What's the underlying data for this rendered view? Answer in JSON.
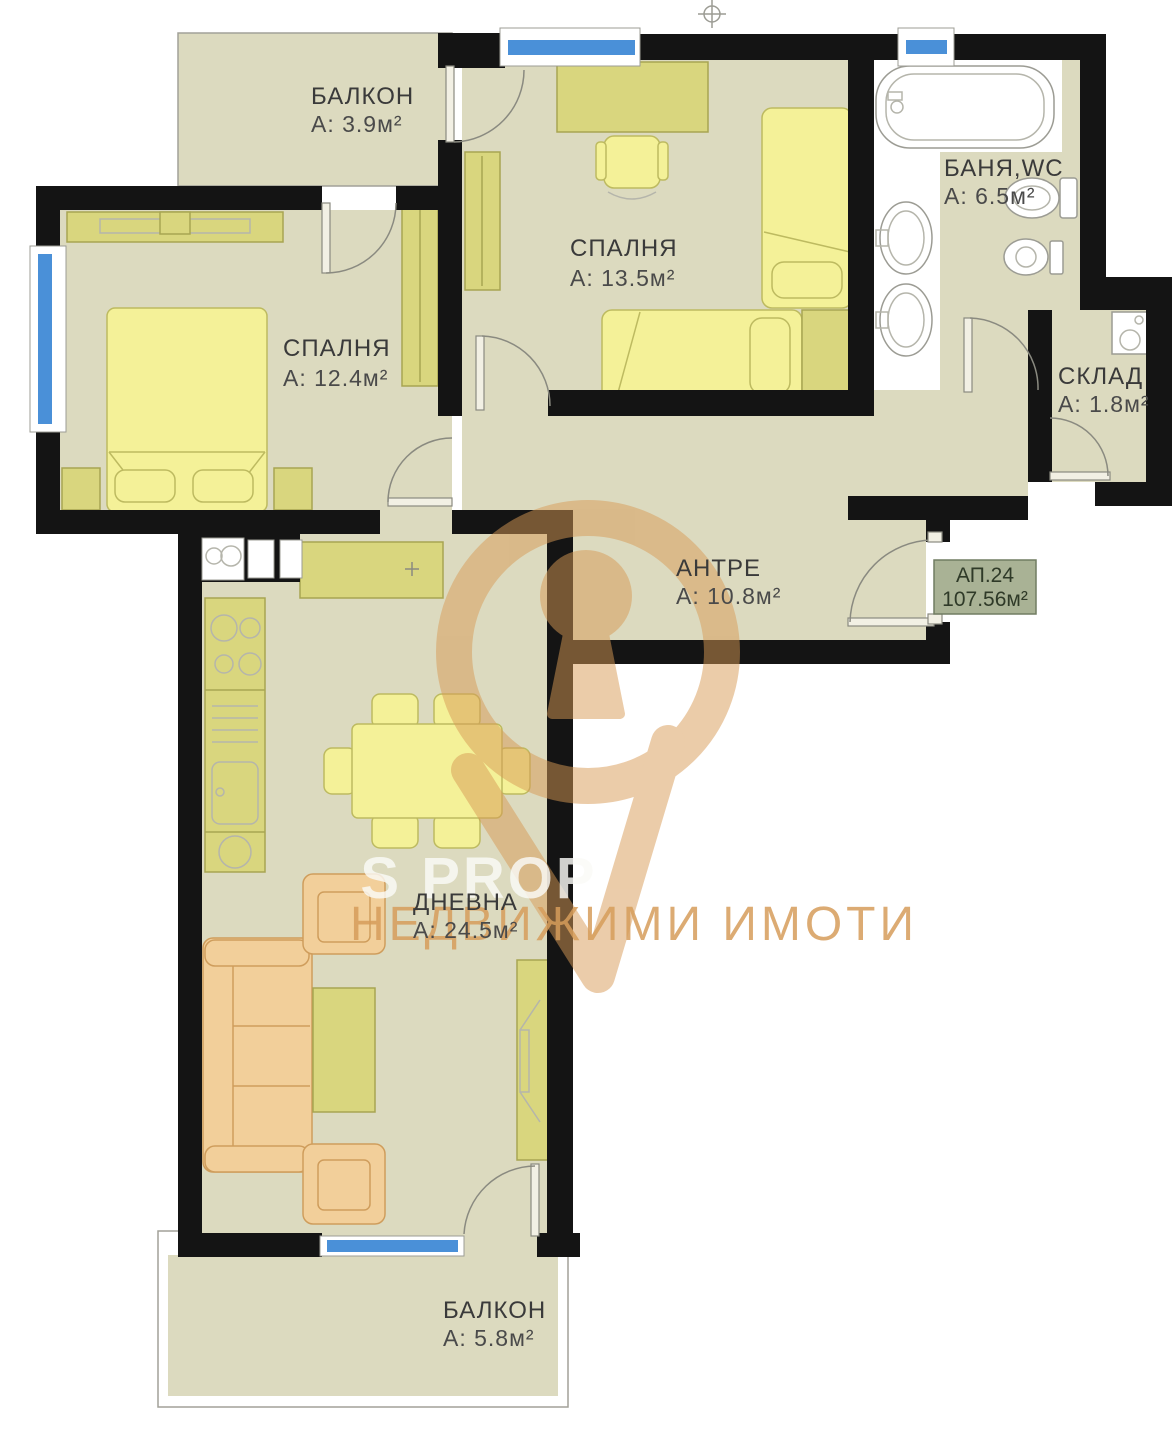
{
  "plan": {
    "rooms": [
      {
        "id": "balcony-top",
        "name": "БАЛКОН",
        "area_label": "А: 3.9м²"
      },
      {
        "id": "bedroom-2",
        "name": "СПАЛНЯ",
        "area_label": "А: 13.5м²"
      },
      {
        "id": "bathroom",
        "name": "БАНЯ,WC",
        "area_label": "А: 6.5м²"
      },
      {
        "id": "bedroom-1",
        "name": "СПАЛНЯ",
        "area_label": "А: 12.4м²"
      },
      {
        "id": "storage",
        "name": "СКЛАД",
        "area_label": "А: 1.8м²"
      },
      {
        "id": "hallway",
        "name": "АНТРЕ",
        "area_label": "А: 10.8м²"
      },
      {
        "id": "living-room",
        "name": "ДНЕВНА",
        "area_label": "А: 24.5м²"
      },
      {
        "id": "balcony-bottom",
        "name": "БАЛКОН",
        "area_label": "А: 5.8м²"
      }
    ],
    "apartment_badge": {
      "number": "АП.24",
      "total_area": "107.56м²"
    },
    "watermark": {
      "brand": "S PROP",
      "tagline": "НЕДВИЖИМИ ИМОТИ"
    },
    "colors": {
      "floor": "#dcdabf",
      "wall": "#141414",
      "window_glass": "#4a90d8",
      "furniture_olive": "#d9d67e",
      "furniture_yellow": "#f4f198",
      "furniture_orange": "#f2cf9a",
      "watermark_orange": "#d89a55",
      "badge_background": "#a9b295"
    }
  }
}
